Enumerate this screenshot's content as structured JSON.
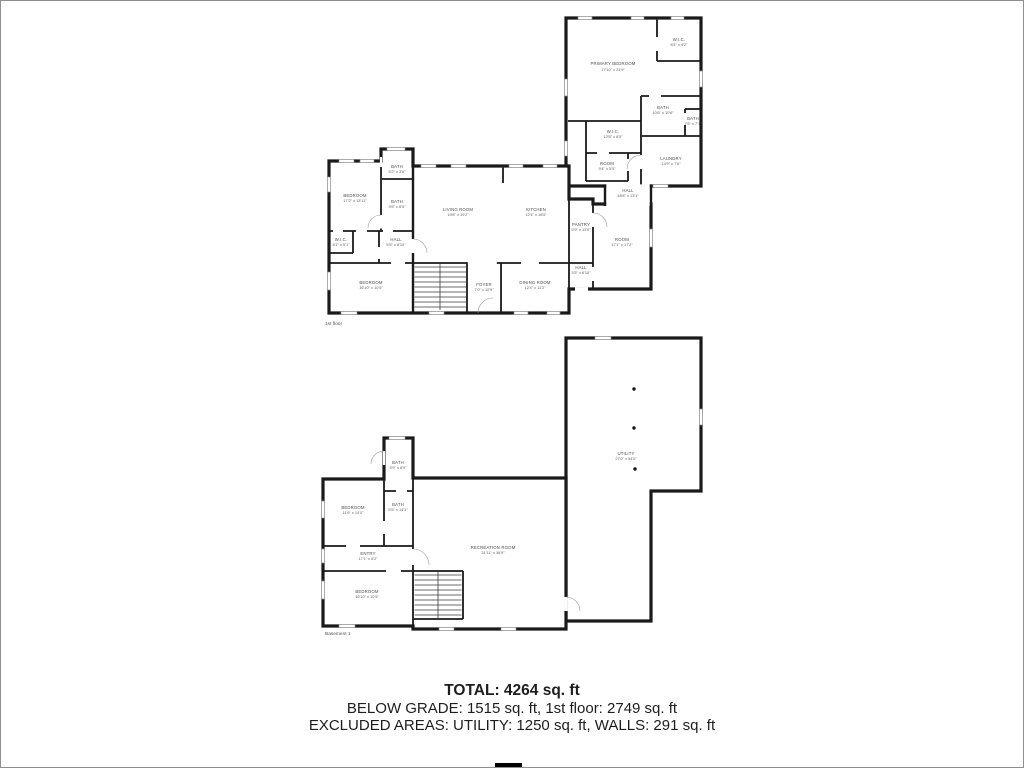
{
  "first_floor": {
    "label": "1st floor",
    "rooms": [
      {
        "id": "primary-bedroom",
        "name": "PRIMARY BEDROOM",
        "dims": "17'10\" x 21'9\""
      },
      {
        "id": "wic-primary",
        "name": "W.I.C.",
        "dims": "8'4\" x 9'2\""
      },
      {
        "id": "bath-primary",
        "name": "BATH",
        "dims": "10'6\" x 10'6\""
      },
      {
        "id": "bath-ensuite",
        "name": "BATH",
        "dims": "7'6\" x 7'1\""
      },
      {
        "id": "wic-2",
        "name": "W.I.C.",
        "dims": "12'8\" x 8'5\""
      },
      {
        "id": "room-small",
        "name": "ROOM",
        "dims": "9'4\" x 5'5\""
      },
      {
        "id": "laundry",
        "name": "LAUNDRY",
        "dims": "14'9\" x 7'6\""
      },
      {
        "id": "hall-upper",
        "name": "HALL",
        "dims": "18'8\" x 13'1\""
      },
      {
        "id": "bedroom-1",
        "name": "BEDROOM",
        "dims": "17'2\" x 13'11\""
      },
      {
        "id": "bath-top",
        "name": "BATH",
        "dims": "5'2\" x 3'6\""
      },
      {
        "id": "bath-mid",
        "name": "BATH",
        "dims": "9'5\" x 8'5\""
      },
      {
        "id": "wic-small",
        "name": "W.I.C.",
        "dims": "5'1\" x 5'1\""
      },
      {
        "id": "hall-left",
        "name": "HALL",
        "dims": "5'5\" x 8'10\""
      },
      {
        "id": "living-room",
        "name": "LIVING ROOM",
        "dims": "19'8\" x 19'2\""
      },
      {
        "id": "kitchen",
        "name": "KITCHEN",
        "dims": "12'4\" x 18'5\""
      },
      {
        "id": "pantry",
        "name": "PANTRY",
        "dims": "5'9\" x 13'9\""
      },
      {
        "id": "room-right",
        "name": "ROOM",
        "dims": "17'1\" x 17'2\""
      },
      {
        "id": "hall-small",
        "name": "HALL",
        "dims": "3'5\" x 6'10\""
      },
      {
        "id": "bedroom-2",
        "name": "BEDROOM",
        "dims": "16'10\" x 10'5\""
      },
      {
        "id": "foyer",
        "name": "FOYER",
        "dims": "7'0\" x 10'9\""
      },
      {
        "id": "dining-room",
        "name": "DINING ROOM",
        "dims": "12'4\" x 11'2\""
      }
    ]
  },
  "basement": {
    "label": "Basement 1",
    "rooms": [
      {
        "id": "utility",
        "name": "UTILITY",
        "dims": "27'0\" x 54'0\""
      },
      {
        "id": "bath-b-top",
        "name": "BATH",
        "dims": "5'9\" x 8'9\""
      },
      {
        "id": "bath-b-mid",
        "name": "BATH",
        "dims": "5'5\" x 14'3\""
      },
      {
        "id": "bedroom-b-1",
        "name": "BEDROOM",
        "dims": "11'9\" x 14'0\""
      },
      {
        "id": "entry",
        "name": "ENTRY",
        "dims": "17'1\" x 8'2\""
      },
      {
        "id": "recreation-room",
        "name": "RECREATION ROOM",
        "dims": "31'11\" x 36'9\""
      },
      {
        "id": "bedroom-b-2",
        "name": "BEDROOM",
        "dims": "16'10\" x 10'5\""
      }
    ]
  },
  "summary": {
    "total": "TOTAL: 4264 sq. ft",
    "below_grade_line": "BELOW GRADE: 1515 sq. ft, 1st floor: 2749 sq. ft",
    "excluded_line": "EXCLUDED AREAS: UTILITY: 1250 sq. ft, WALLS: 291 sq. ft"
  },
  "colors": {
    "wall": "#1a1a1a",
    "room_label": "#4d4d4d",
    "summary_text": "#1d1d1d"
  }
}
